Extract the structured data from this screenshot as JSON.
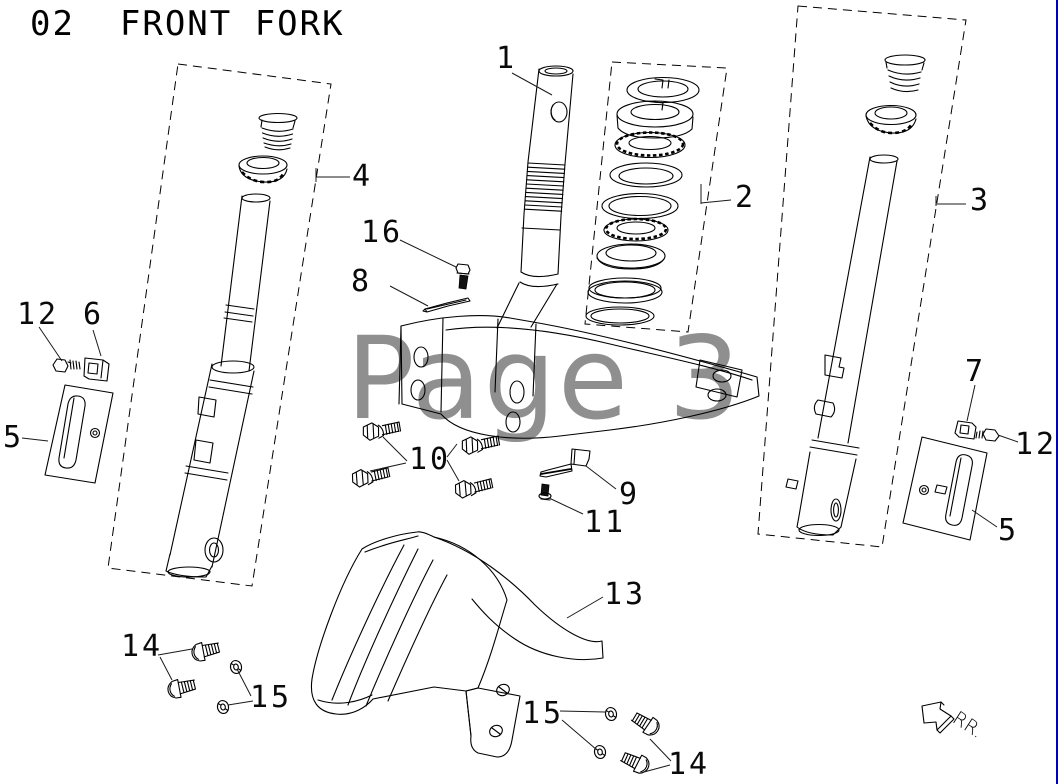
{
  "page": {
    "title": "02  FRONT FORK",
    "watermark": "Page 3",
    "direction_label": "RR."
  },
  "colors": {
    "watermark": "#8f8f8f",
    "edge_line": "#0000c0",
    "line_art": "#000000"
  },
  "callouts": [
    {
      "num": "1",
      "x": 496,
      "y": 44
    },
    {
      "num": "2",
      "x": 735,
      "y": 183
    },
    {
      "num": "3",
      "x": 970,
      "y": 186
    },
    {
      "num": "4",
      "x": 352,
      "y": 162
    },
    {
      "num": "5",
      "x": 3,
      "y": 423
    },
    {
      "num": "6",
      "x": 83,
      "y": 300
    },
    {
      "num": "7",
      "x": 965,
      "y": 357
    },
    {
      "num": "8",
      "x": 351,
      "y": 267
    },
    {
      "num": "9",
      "x": 619,
      "y": 480
    },
    {
      "num": "10",
      "x": 409,
      "y": 445
    },
    {
      "num": "11",
      "x": 584,
      "y": 508
    },
    {
      "num": "12",
      "x": 17,
      "y": 300
    },
    {
      "num": "12",
      "x": 1015,
      "y": 430
    },
    {
      "num": "13",
      "x": 604,
      "y": 580
    },
    {
      "num": "14",
      "x": 121,
      "y": 632
    },
    {
      "num": "14",
      "x": 668,
      "y": 750
    },
    {
      "num": "15",
      "x": 250,
      "y": 683
    },
    {
      "num": "15",
      "x": 522,
      "y": 699
    },
    {
      "num": "16",
      "x": 361,
      "y": 218
    },
    {
      "num": "5",
      "x": 998,
      "y": 516
    }
  ]
}
